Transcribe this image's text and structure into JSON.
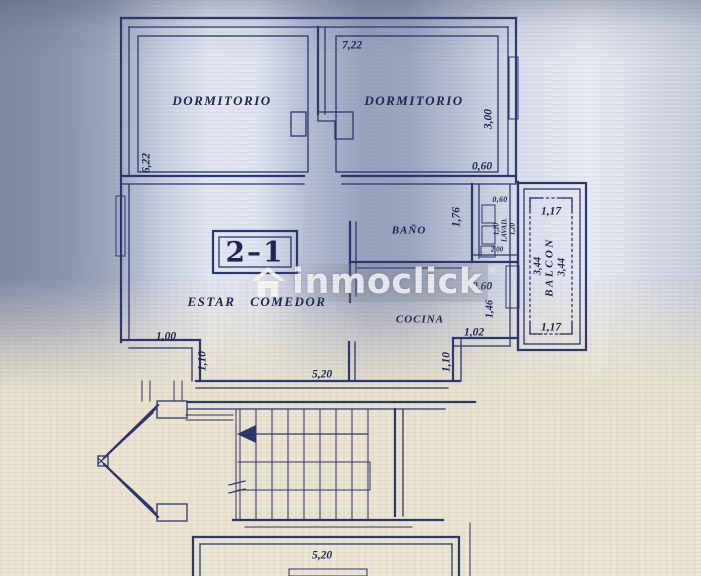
{
  "plan": {
    "unit_label": "2–1",
    "rooms": {
      "dormitorio_left": "DORMITORIO",
      "dormitorio_right": "DORMITORIO",
      "bano": "BAÑO",
      "estar_comedor": "ESTAR COMEDOR",
      "cocina": "COCINA",
      "lavadero": "LAVAD.",
      "balcon": "BALCON"
    },
    "dims": {
      "top_width": "7,22",
      "left_height": "6,22",
      "bedroom_right_height": "3,00",
      "entry_door": "0,60",
      "bano_width": "1,76",
      "lavadero_top": "0,60",
      "lavadero_left": "1,20",
      "lavadero_right": "1,20",
      "lavadero_bottom": "2,00",
      "balcon_top": "1,17",
      "balcon_bottom": "1,17",
      "balcon_left": "3,44",
      "balcon_right": "3,44",
      "cocina_door": "0,60",
      "cocina_right": "1,46",
      "cocina_bottom": "1,02",
      "hall_left_top": "1,00",
      "hall_left": "1,10",
      "hall_width": "5,20",
      "hall_right": "1,10",
      "landing_width": "5,20"
    },
    "watermark": {
      "brand": "inmoclick",
      "registered_mark": "®",
      "icon": "house-icon"
    },
    "colors": {
      "ink": "#2b356d",
      "paper_beige": "#e9e3cf",
      "shadow_blue": "#97a1bd"
    }
  }
}
